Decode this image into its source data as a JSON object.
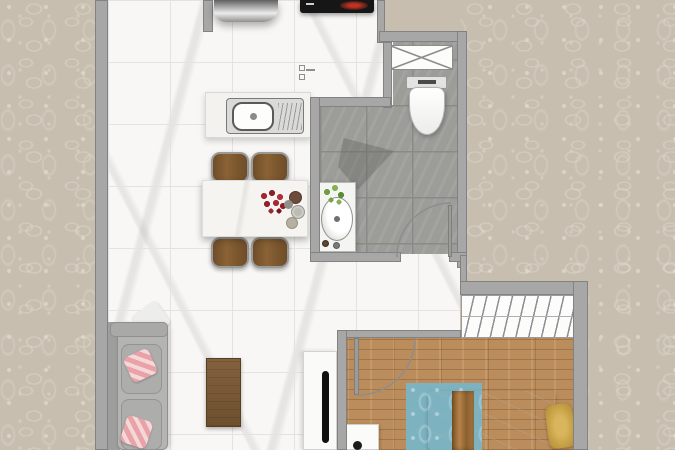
{
  "scene": {
    "title": "apartment-floor-plan-top-view",
    "description": "Rendered one-bedroom apartment floor plan on damask wallpaper background"
  },
  "palette": {
    "wallpaper": "#c7beb0",
    "wall": "#a7a7a7",
    "wall_edge": "#828282",
    "marble": "#f8f7f5",
    "grout": "#e4e3e1",
    "bath_tile": "#9c9c98",
    "bath_grout": "#8a8a86",
    "wood": "#bb8d5c",
    "rug": "#7db3c0",
    "sofa": "#b4b4b2",
    "sofa_back": "#9e9e9c",
    "cushion": "#adadab",
    "pillow_pink": "#e9a3a8",
    "chair_wood": "#7d5833",
    "chrome": "#c9c9c9",
    "table": "#f5f4f1",
    "flower_red": "#a32531",
    "cooktop": "#161616",
    "burner_red": "#c23222",
    "gold": "#c9a449",
    "runner_brown": "#9a6a33",
    "plant_green": "#74a348",
    "line_gray": "#8d8d8d"
  },
  "rooms": {
    "kitchen": {
      "floor": "white-marble-tile",
      "items": [
        "range-appliance",
        "cooktop",
        "sink-counter",
        "valve-symbol"
      ]
    },
    "dining": {
      "floor": "white-marble-tile",
      "items": [
        "marble-dining-table",
        "wood-chair",
        "wood-chair",
        "wood-chair",
        "wood-chair",
        "flower-centerpiece",
        "plates"
      ]
    },
    "living": {
      "floor": "white-marble-tile",
      "items": [
        "gray-sofa",
        "pink-pillow",
        "pink-pillow",
        "white-throw",
        "coffee-table",
        "tv-console",
        "tv"
      ]
    },
    "bathroom": {
      "floor": "gray-stone-tile",
      "items": [
        "duct-shaft",
        "toilet",
        "vanity-basin",
        "plant",
        "shower-mat",
        "door-swing"
      ]
    },
    "bedroom": {
      "floor": "wood-plank",
      "items": [
        "wardrobe-hanger-rack",
        "double-bed",
        "bed-runner",
        "gold-pillow",
        "blue-rug",
        "nightstand",
        "lamp",
        "door-swing"
      ]
    }
  }
}
